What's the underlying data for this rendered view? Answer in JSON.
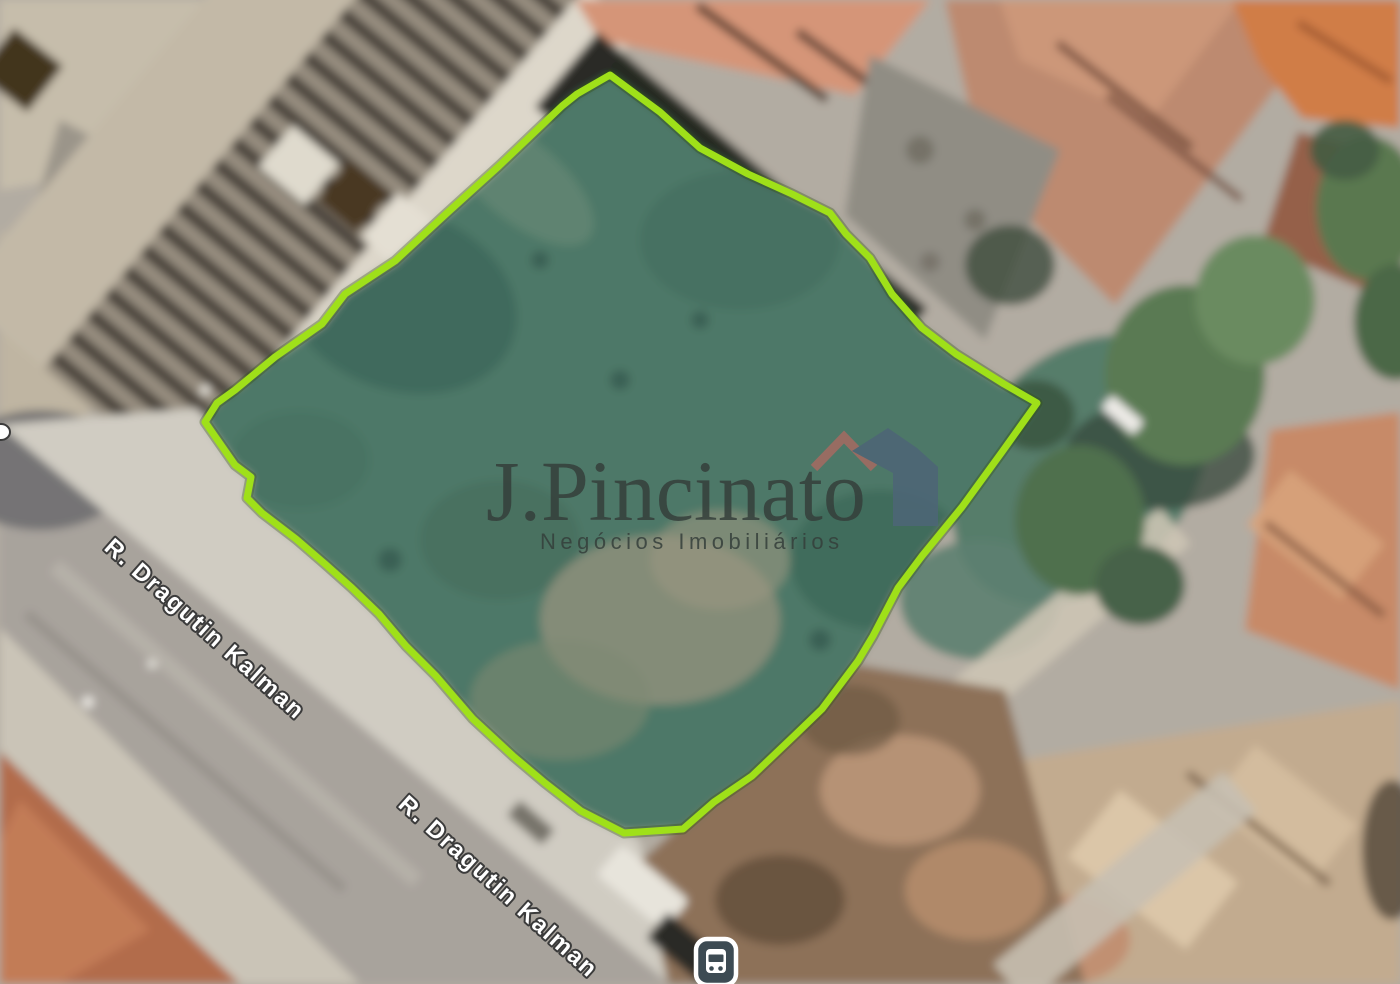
{
  "map": {
    "view": "satellite",
    "street_labels": [
      {
        "text": "R. Dragutin Kalman"
      },
      {
        "text": "R. Dragutin Kalman"
      }
    ],
    "property_outline": {
      "color": "#9fe019"
    },
    "transit_stop": {
      "kind": "bus",
      "bg_color": "#3d4b53"
    }
  },
  "watermark": {
    "brand": "J.Pincinato",
    "tagline": "Negócios Imobiliários",
    "text_color": "#353f3b",
    "logo_roof_color": "#a66a62",
    "logo_house_color": "#4d6577"
  }
}
